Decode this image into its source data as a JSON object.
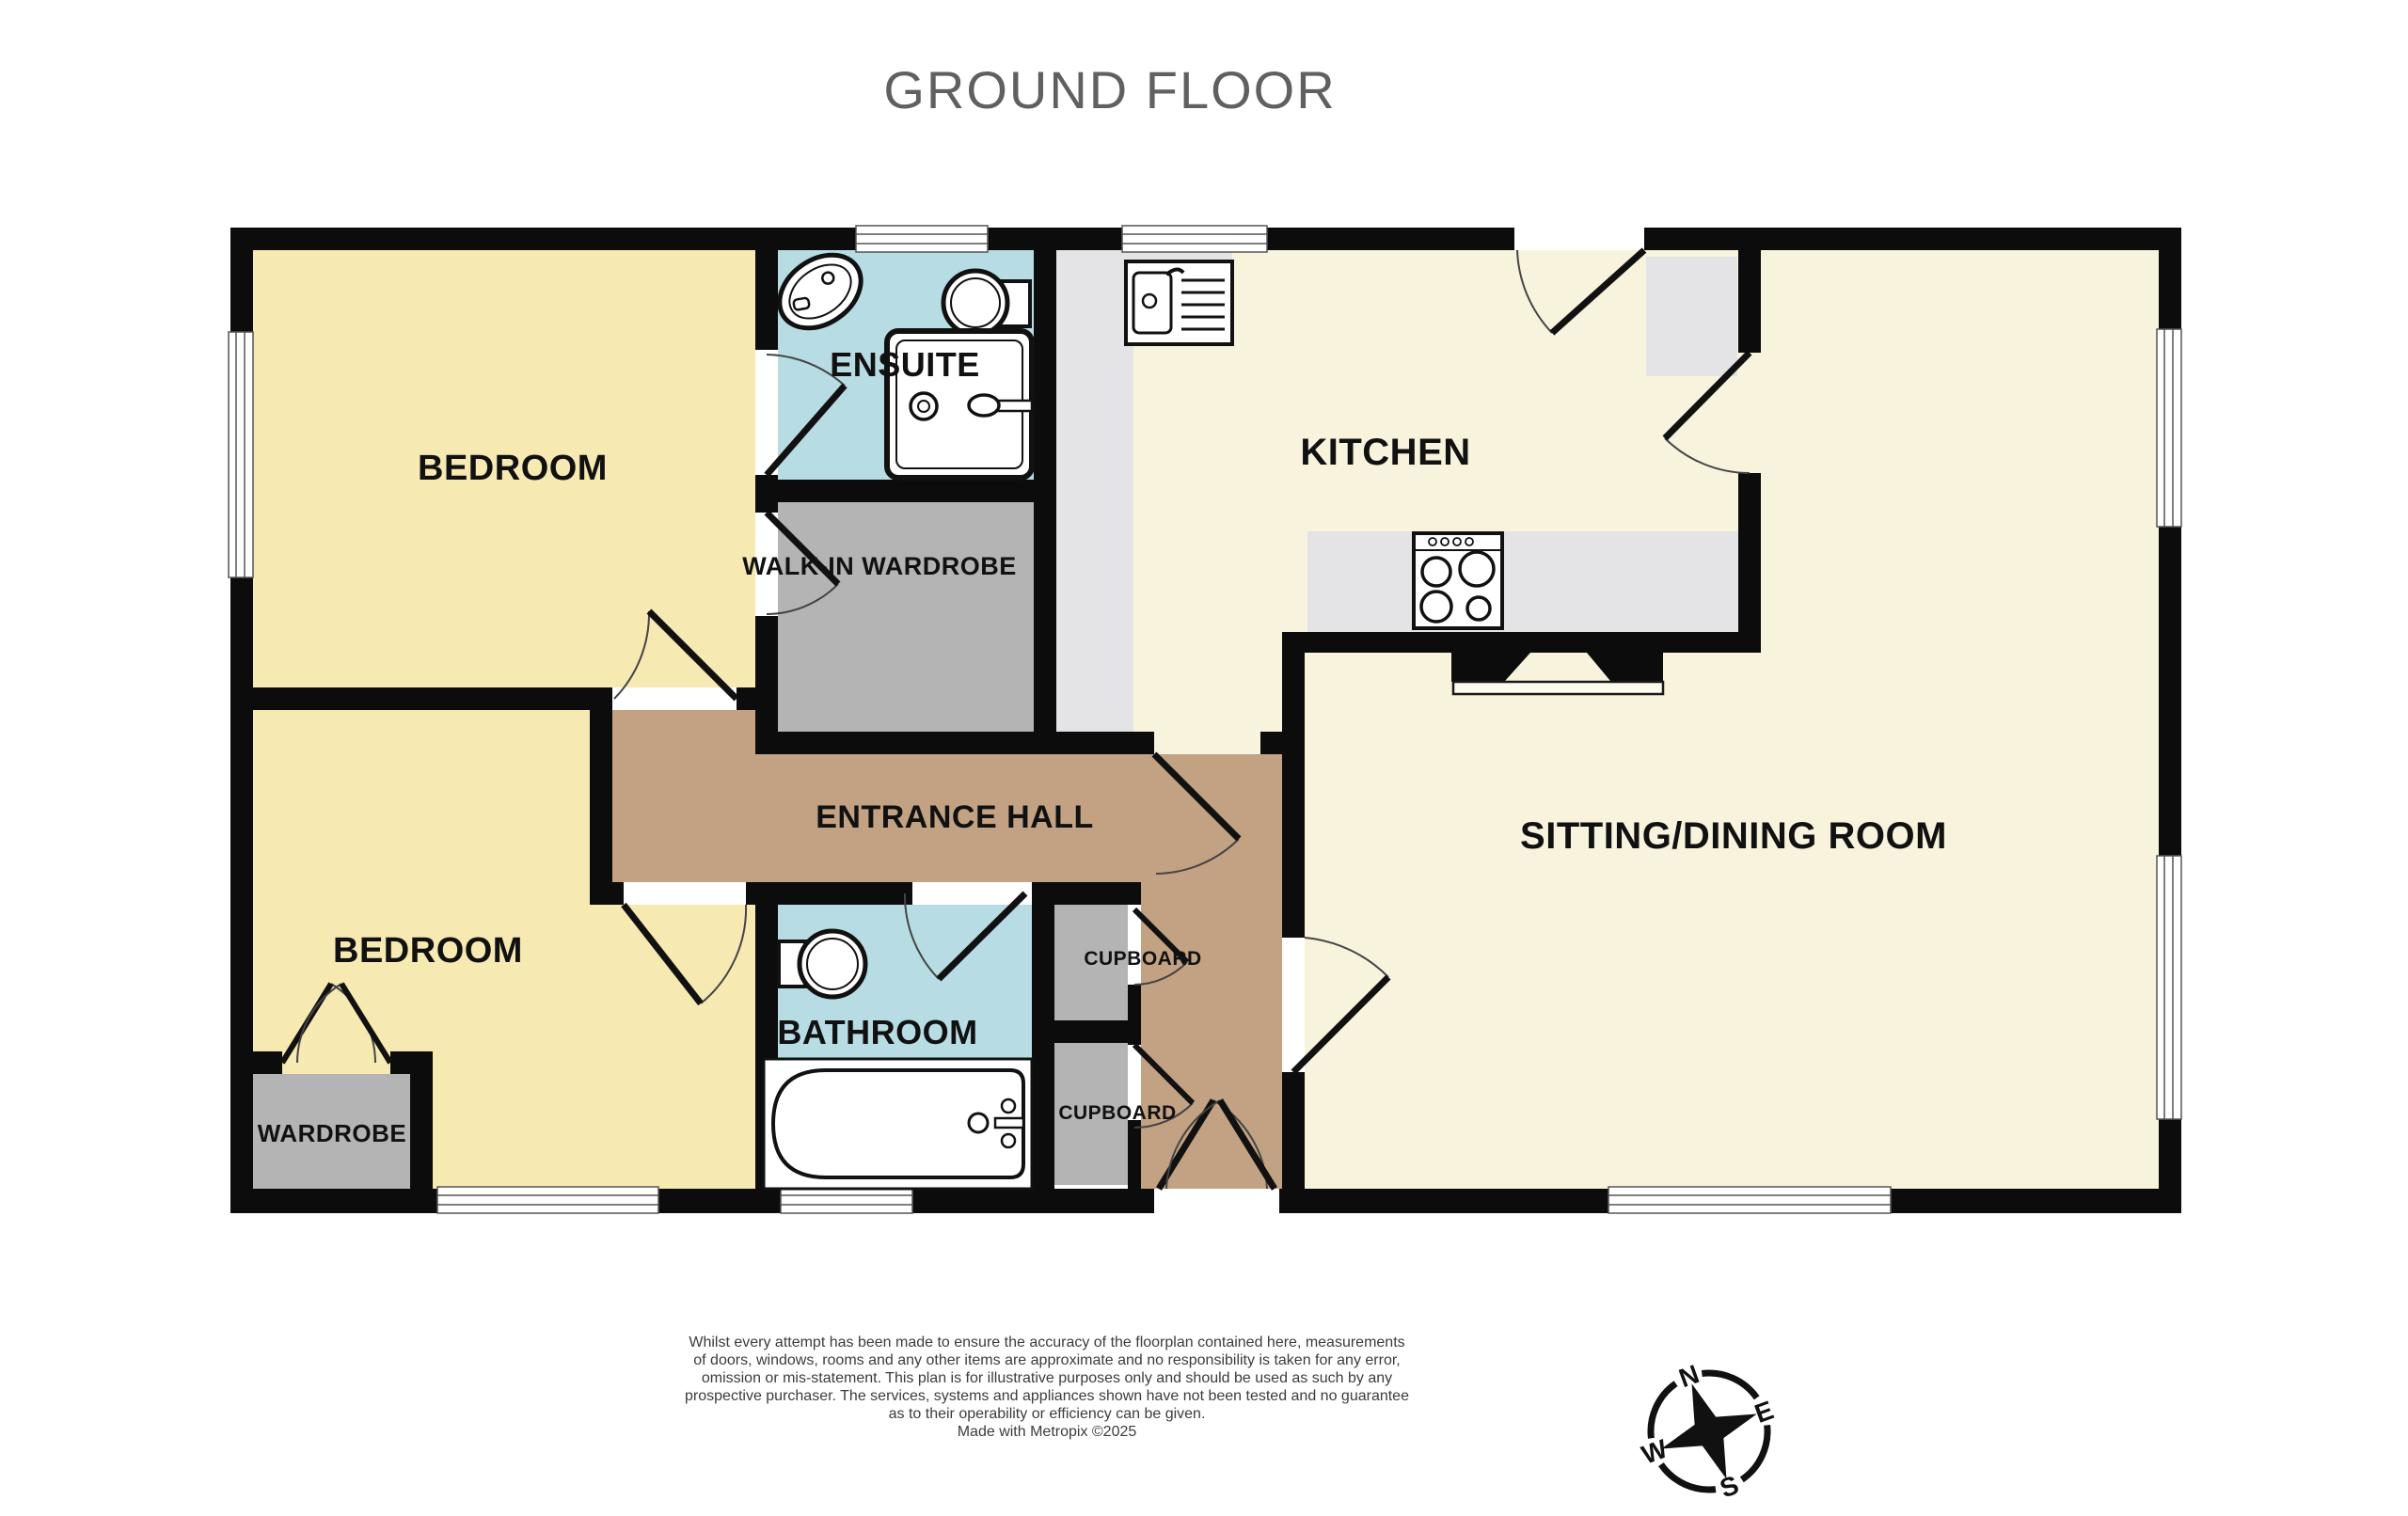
{
  "title": "GROUND FLOOR",
  "colors": {
    "wall": "#0c0c0c",
    "bedroom_fill": "#f6e9b2",
    "cream_fill": "#f8f3dd",
    "wet_room_fill": "#b7dce3",
    "store_fill": "#b4b4b4",
    "counter_fill": "#e4e4e6",
    "hall_fill": "#c2a283",
    "title_gray": "#606060"
  },
  "rooms": {
    "bedroom1": {
      "label": "BEDROOM"
    },
    "bedroom2": {
      "label": "BEDROOM"
    },
    "ensuite": {
      "label": "ENSUITE"
    },
    "walk_in_wardrobe": {
      "label": "WALK-IN WARDROBE"
    },
    "kitchen": {
      "label": "KITCHEN"
    },
    "sitting_dining": {
      "label": "SITTING/DINING ROOM"
    },
    "entrance_hall": {
      "label": "ENTRANCE HALL"
    },
    "bathroom": {
      "label": "BATHROOM"
    },
    "cupboard_upper": {
      "label": "CUPBOARD"
    },
    "cupboard_lower": {
      "label": "CUPBOARD"
    },
    "wardrobe": {
      "label": "WARDROBE"
    }
  },
  "compass": {
    "north": "N",
    "east": "E",
    "south": "S",
    "west": "W"
  },
  "disclaimer": {
    "line1": "Whilst every attempt has been made to ensure the accuracy of the floorplan contained here, measurements",
    "line2": "of doors, windows, rooms and any other items are approximate and no responsibility is taken for any error,",
    "line3": "omission or mis-statement. This plan is for illustrative purposes only and should be used as such by any",
    "line4": "prospective purchaser. The services, systems and appliances shown have not been tested and no guarantee",
    "line5": "as to their operability or efficiency can be given.",
    "line6": "Made with Metropix ©2025"
  }
}
